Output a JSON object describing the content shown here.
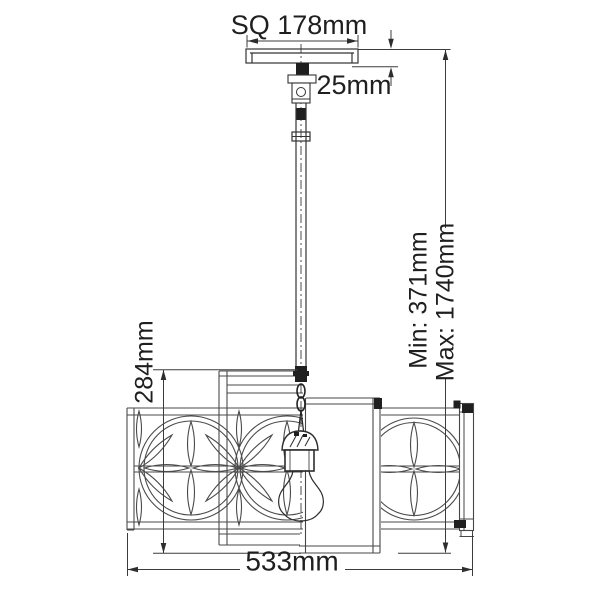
{
  "drawing": {
    "subject": "Square pendant ceiling light - dimensioned elevation drawing"
  },
  "labels": {
    "canopy_square": "SQ 178mm",
    "canopy_height": "25mm",
    "min_drop": "Min: 371mm",
    "max_drop": "Max: 1740mm",
    "shade_height": "284mm",
    "overall_width": "533mm"
  },
  "colors": {
    "line": "#4a4a4a",
    "stem_line": "#333333",
    "dark_fill": "#1f1f1f",
    "text": "#1f1f1f",
    "background": "#ffffff"
  }
}
